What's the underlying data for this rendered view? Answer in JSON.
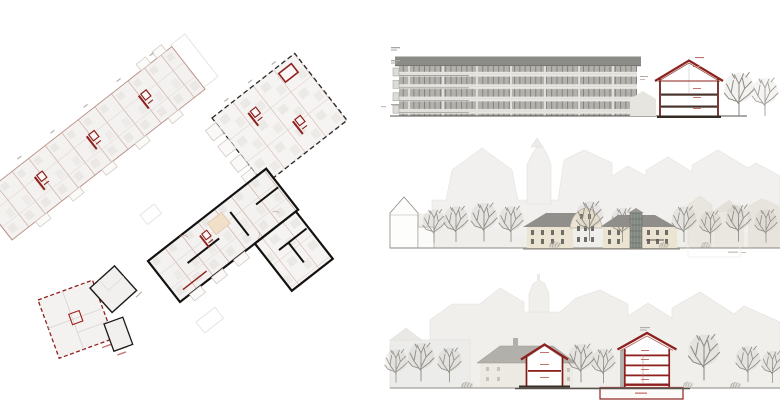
{
  "sheet": {
    "background": "#ffffff",
    "width": 780,
    "height": 405
  },
  "colors": {
    "plan_fill": "#f3f2f0",
    "plan_line": "#c7a29a",
    "plan_red": "#8e211d",
    "plan_black": "#1c1a18",
    "elevation_roof": "#8b8b88",
    "elevation_facade": "#e9e7e3",
    "elevation_window": "#b2b1ac",
    "section_red": "#8e211d",
    "slab_dark": "#46362e",
    "context_fill": "#f1f0ee",
    "context_line": "#e4e2dd",
    "cream_wall": "#ebe4d3",
    "cream_roof": "#908f8b",
    "tree": "#8f8c85",
    "ground": "#8c8880",
    "annotation": "#b6b1ab",
    "annotation_red": "#c4736e"
  },
  "panels": {
    "floor_plans": {
      "name": "floor plans"
    },
    "building_elevation": {
      "name": "building elevation",
      "window_rows": 4
    },
    "house_section": {
      "name": "house cross-section",
      "floors": 2
    },
    "street_elevation": {
      "name": "street elevation"
    },
    "street_section": {
      "name": "street section",
      "floors": 4,
      "has_basement": true
    }
  }
}
